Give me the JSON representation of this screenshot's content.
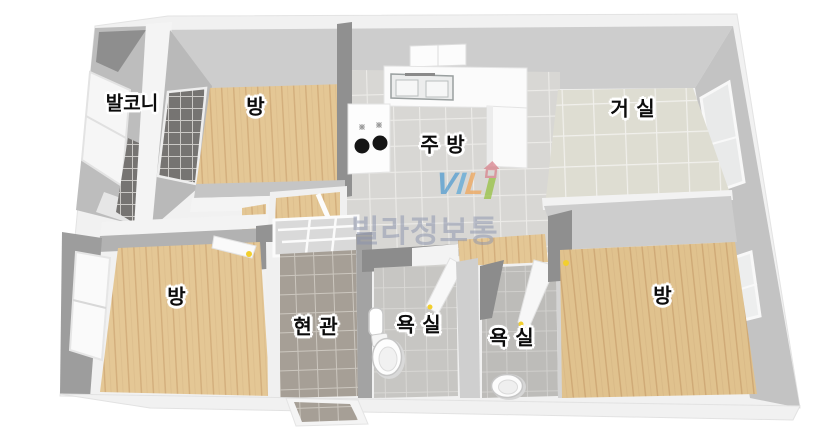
{
  "floor_plan": {
    "rooms": {
      "balcony": {
        "label": "발코니"
      },
      "bedroom_top": {
        "label": "방"
      },
      "kitchen": {
        "label": "주 방"
      },
      "living_room": {
        "label": "거 실"
      },
      "bedroom_left": {
        "label": "방"
      },
      "entrance": {
        "label": "현 관"
      },
      "bathroom_1": {
        "label": "욕 실"
      },
      "bathroom_2": {
        "label": "욕 실"
      },
      "bedroom_right": {
        "label": "방"
      }
    }
  },
  "watermark": {
    "logo_letters": [
      {
        "char": "V",
        "color": "#4f9bd0"
      },
      {
        "char": "I",
        "color": "#5aa7d8"
      },
      {
        "char": "L",
        "color": "#f0a455"
      }
    ],
    "logo_post_color": "#95c13d",
    "logo_house_color": "#d9808a",
    "text": "빌라정보통",
    "text_color": "#8a93ad"
  },
  "palette": {
    "wood_floor": "#e4c795",
    "kitchen_tile": "#d8d7d4",
    "living_tile": "#deddd2",
    "bath_tile": "#c7c6c3",
    "entry_tile": "#a69f96",
    "wall_inner_gray": "#a8a8a8",
    "wall_light_gray": "#cdcdcd",
    "wall_outer_white": "#f1f1f1",
    "door_handle_yellow": "#f2cf2e",
    "stove_burner_black": "#151515"
  }
}
